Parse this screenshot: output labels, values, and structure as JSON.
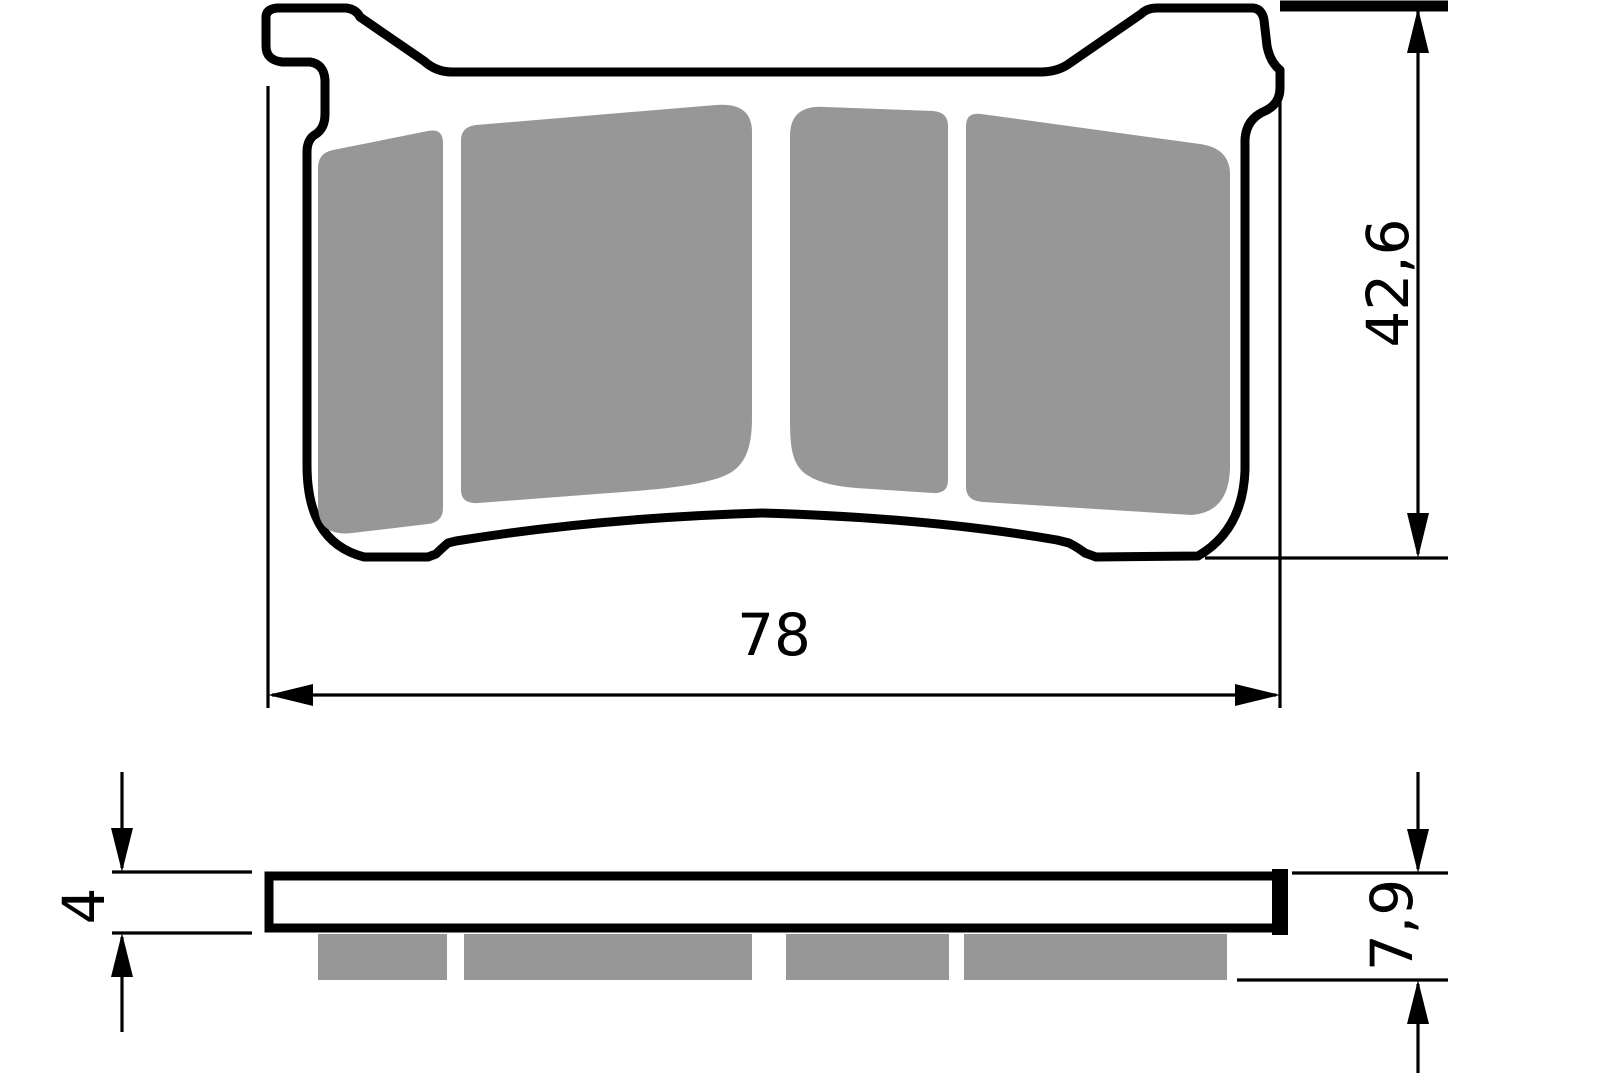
{
  "drawing": {
    "part": "brake-pad",
    "view_count": 2,
    "dimensions": {
      "overall_width": "78",
      "overall_height": "42,6",
      "backplate_thickness": "4",
      "total_thickness": "7,9"
    },
    "colors": {
      "outline": "#000000",
      "friction_material": "#979797",
      "background": "#ffffff",
      "dimension_lines": "#000000"
    }
  }
}
